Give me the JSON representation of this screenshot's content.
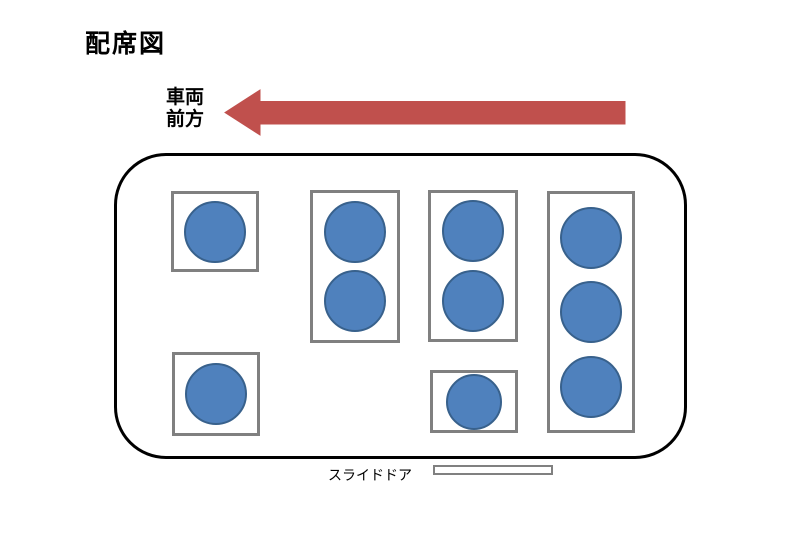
{
  "title": "配席図",
  "front_label": {
    "line1": "車両",
    "line2": "前方"
  },
  "door_label": "スライドドア",
  "colors": {
    "seat_fill": "#4F81BD",
    "seat_border": "#38618C",
    "box_border": "#808080",
    "arrow_fill": "#C0504D",
    "vehicle_outline": "#000000"
  },
  "diagram": {
    "type": "vehicle-seating-chart",
    "front_direction": "left",
    "total_seats": 10,
    "vehicle": {
      "x": 114,
      "y": 153,
      "w": 573,
      "h": 306,
      "corner_radius": 52
    },
    "seat_groups": [
      {
        "id": "front-upper-single",
        "seats": 1,
        "x": 171,
        "y": 191,
        "w": 88,
        "h": 81
      },
      {
        "id": "second-row-double",
        "seats": 2,
        "x": 310,
        "y": 190,
        "w": 90,
        "h": 153
      },
      {
        "id": "third-row-upper-double",
        "seats": 2,
        "x": 428,
        "y": 190,
        "w": 90,
        "h": 152
      },
      {
        "id": "rear-bench-triple",
        "seats": 3,
        "x": 547,
        "y": 191,
        "w": 88,
        "h": 242
      },
      {
        "id": "front-lower-single",
        "seats": 1,
        "x": 172,
        "y": 352,
        "w": 88,
        "h": 84
      },
      {
        "id": "third-row-lower-single",
        "seats": 1,
        "x": 430,
        "y": 370,
        "w": 88,
        "h": 63,
        "seat_size": 56
      }
    ],
    "door": {
      "x": 433,
      "y": 465,
      "w": 120,
      "h": 10
    }
  }
}
